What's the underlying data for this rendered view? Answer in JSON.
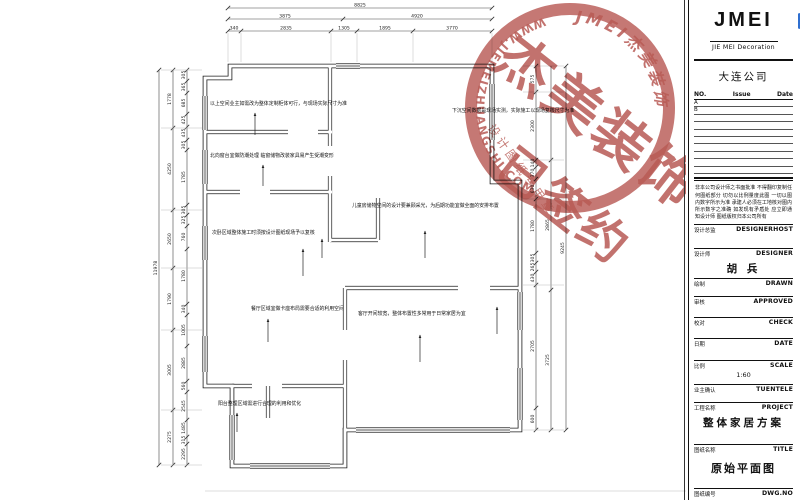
{
  "sheet": {
    "bg": "#ffffff",
    "line_color": "#1c1c1c",
    "corner_mark_color": "#2f6fd0"
  },
  "title_block": {
    "logo": "JMEI",
    "logo_sub": "JIE MEI Decoration",
    "company": "大连公司",
    "rev_header": {
      "no": "NO.",
      "issue": "Issue",
      "date": "Date"
    },
    "revision_rows": [
      "A",
      "B",
      "",
      "",
      "",
      "",
      "",
      "",
      "",
      ""
    ],
    "notes": "非本公司设计师之书面批准 不得翻印复制任何图纸部分 切勿以比例量度此图 一切以图内数字所示为准 承建人必须在工地核对图内所示数字之准确 如发现有矛盾处 应立即通知设计师 图纸版权归本公司所有",
    "fields": [
      {
        "label_cn": "设计总监",
        "label_en": "DESIGNERHOST",
        "value": ""
      },
      {
        "label_cn": "设计师",
        "label_en": "DESIGNER",
        "value": "胡 兵"
      },
      {
        "label_cn": "绘制",
        "label_en": "DRAWN",
        "value": ""
      },
      {
        "label_cn": "审核",
        "label_en": "APPROVED",
        "value": ""
      },
      {
        "label_cn": "校对",
        "label_en": "CHECK",
        "value": ""
      },
      {
        "label_cn": "日期",
        "label_en": "DATE",
        "value": ""
      },
      {
        "label_cn": "比例",
        "label_en": "SCALE",
        "value": "1:60"
      },
      {
        "label_cn": "业主确认",
        "label_en": "TUENTELE",
        "value": ""
      },
      {
        "label_cn": "工程名称",
        "label_en": "PROJECT",
        "value": "整体家居方案"
      },
      {
        "label_cn": "图纸名称",
        "label_en": "TITLE",
        "value": "原始平面图"
      },
      {
        "label_cn": "图纸编号",
        "label_en": "DWG.NO",
        "value": ""
      }
    ]
  },
  "stamp": {
    "big_text": "杰美装饰",
    "signed_text": "已签约",
    "seal_small_text": "设计图纸专用章",
    "arc_top": "JMEI杰美装饰",
    "url": "WWW.JIEMEIZHUANGSHI.COM",
    "color": "#a8362f"
  },
  "plan": {
    "dims_top": {
      "total": "8825",
      "row2": [
        "3875",
        "4920"
      ],
      "row3": [
        "340",
        "2835",
        "1305",
        "1895",
        "3770"
      ]
    },
    "dims_left": {
      "total": "11978",
      "mid": [
        "1778",
        "4250",
        "2650",
        "1790",
        "3005",
        "2275"
      ],
      "inner": [
        "305",
        "365",
        "685",
        "425",
        "435",
        "305",
        "1785",
        "305",
        "325",
        "760",
        "1780",
        "340",
        "1005",
        "2885",
        "560",
        "2545",
        "1485",
        "315",
        "2295"
      ]
    },
    "dims_right": {
      "total": "9245",
      "mid": [
        "2865",
        "3725"
      ],
      "inner": [
        "575",
        "2300",
        "140",
        "370",
        "630",
        "1780",
        "305",
        "265",
        "430",
        "2705",
        "600"
      ]
    },
    "annotations": [
      "以上空间业主如需改为整体定制柜体可行，与现场实际尺寸为准",
      "下沉空间数据是现场实测，实际施工以现场复核尺寸为准",
      "北向窗台宜做防潮处理 临窗储物改装家具易产生受潮变形",
      "儿童房储物空间的设计要兼顾采光，为后期功能宜做全面的安排布置",
      "次卧区域整体施工时须按设计图纸现场予以复核",
      "餐厅区域宜做卡座布局需要合适的利用空间",
      "客厅开间较宽，整体布置性多常用于日常家居为宜",
      "阳台整理区域需进行合理的利用和优化"
    ]
  }
}
